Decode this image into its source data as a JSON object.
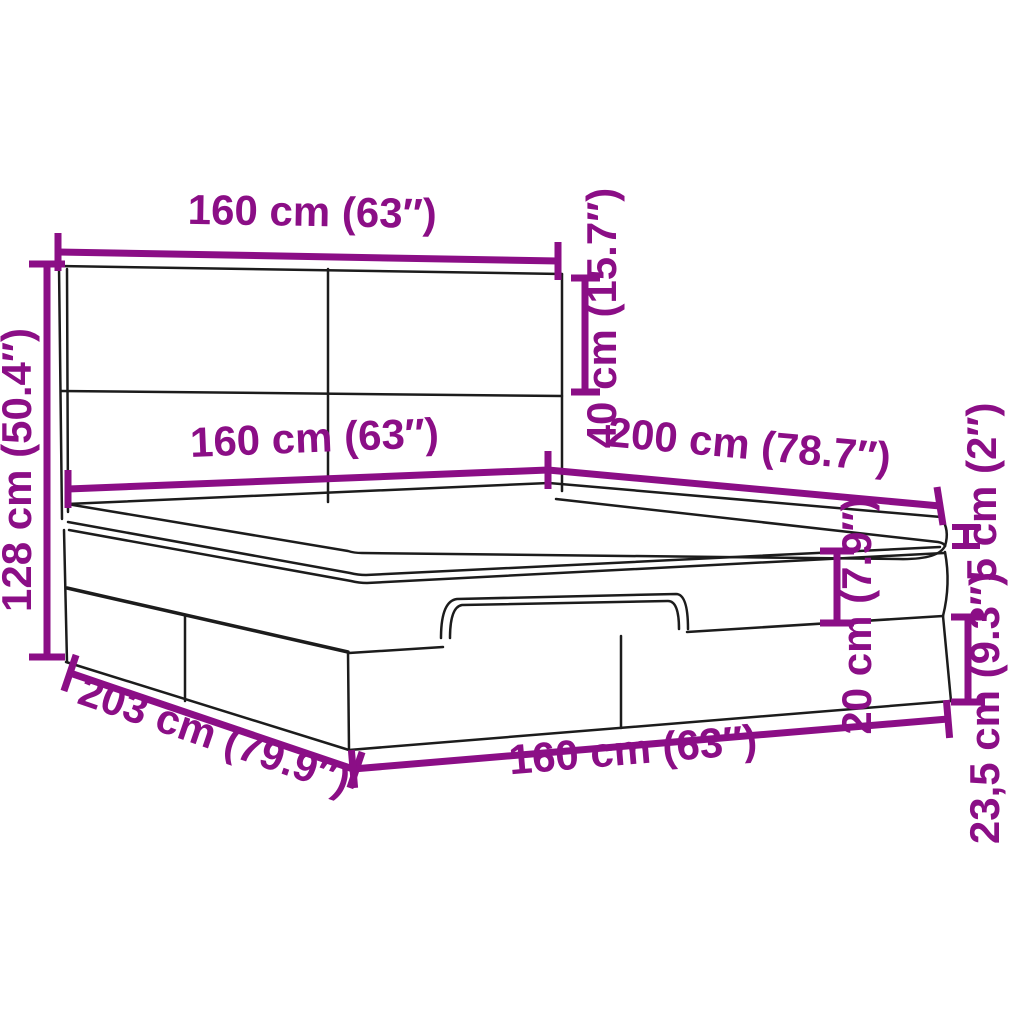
{
  "diagram": {
    "type": "furniture-dimension-diagram",
    "subject": "ottoman storage bed with headboard",
    "colors": {
      "dimension_accent": "#8B0E86",
      "outline": "#1C1C1C",
      "background": "#FFFFFF"
    },
    "dimensions": {
      "headboard_width": {
        "label": "160 cm (63″)",
        "cm": 160,
        "inch": 63
      },
      "headboard_panel_height": {
        "label": "40 cm (15.7″)",
        "cm": 40,
        "inch": 15.7
      },
      "total_height": {
        "label": "128 cm (50.4″)",
        "cm": 128,
        "inch": 50.4
      },
      "mattress_width": {
        "label": "160 cm (63″)",
        "cm": 160,
        "inch": 63
      },
      "mattress_length": {
        "label": "200 cm (78.7″)",
        "cm": 200,
        "inch": 78.7
      },
      "topper_thickness": {
        "label": "5 cm (2″)",
        "cm": 5,
        "inch": 2
      },
      "upper_box_height": {
        "label": "20 cm (7.9″)",
        "cm": 20,
        "inch": 7.9
      },
      "storage_section_height": {
        "label": "23,5 cm (9.3″)",
        "cm": 23.5,
        "inch": 9.3
      },
      "frame_length": {
        "label": "203 cm (79.9″)",
        "cm": 203,
        "inch": 79.9
      },
      "frame_width": {
        "label": "160 cm (63″)",
        "cm": 160,
        "inch": 63
      }
    }
  }
}
